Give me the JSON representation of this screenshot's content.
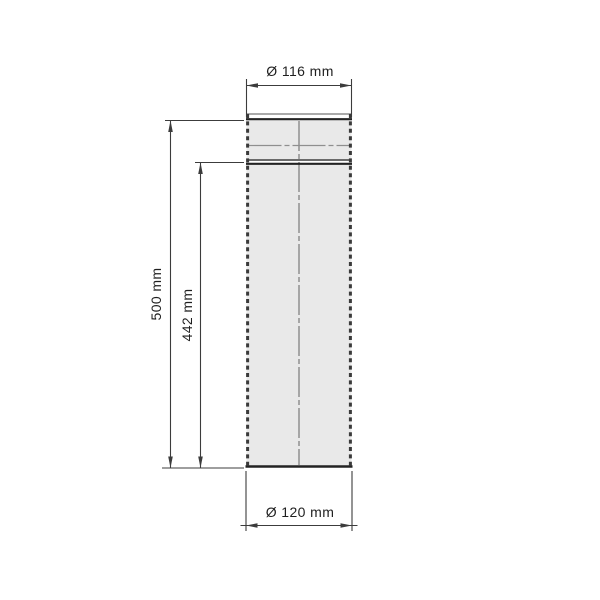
{
  "colors": {
    "background": "#ffffff",
    "pipe_fill": "#e9e9e9",
    "outline_dark": "#232323",
    "outline_medium": "#555555",
    "edge_dash": "#3a3a3a",
    "centerline": "#8f8f8f",
    "dimension_line": "#3c3c3c",
    "text": "#1f1f1f"
  },
  "drawing": {
    "labels": {
      "top_diameter": "Ø 116 mm",
      "bottom_diameter": "Ø 120 mm",
      "overall_length": "500 mm",
      "inner_length": "442 mm"
    },
    "values": {
      "top_diameter_mm": 116,
      "bottom_diameter_mm": 120,
      "overall_length_mm": 500,
      "inner_length_mm": 442
    }
  }
}
